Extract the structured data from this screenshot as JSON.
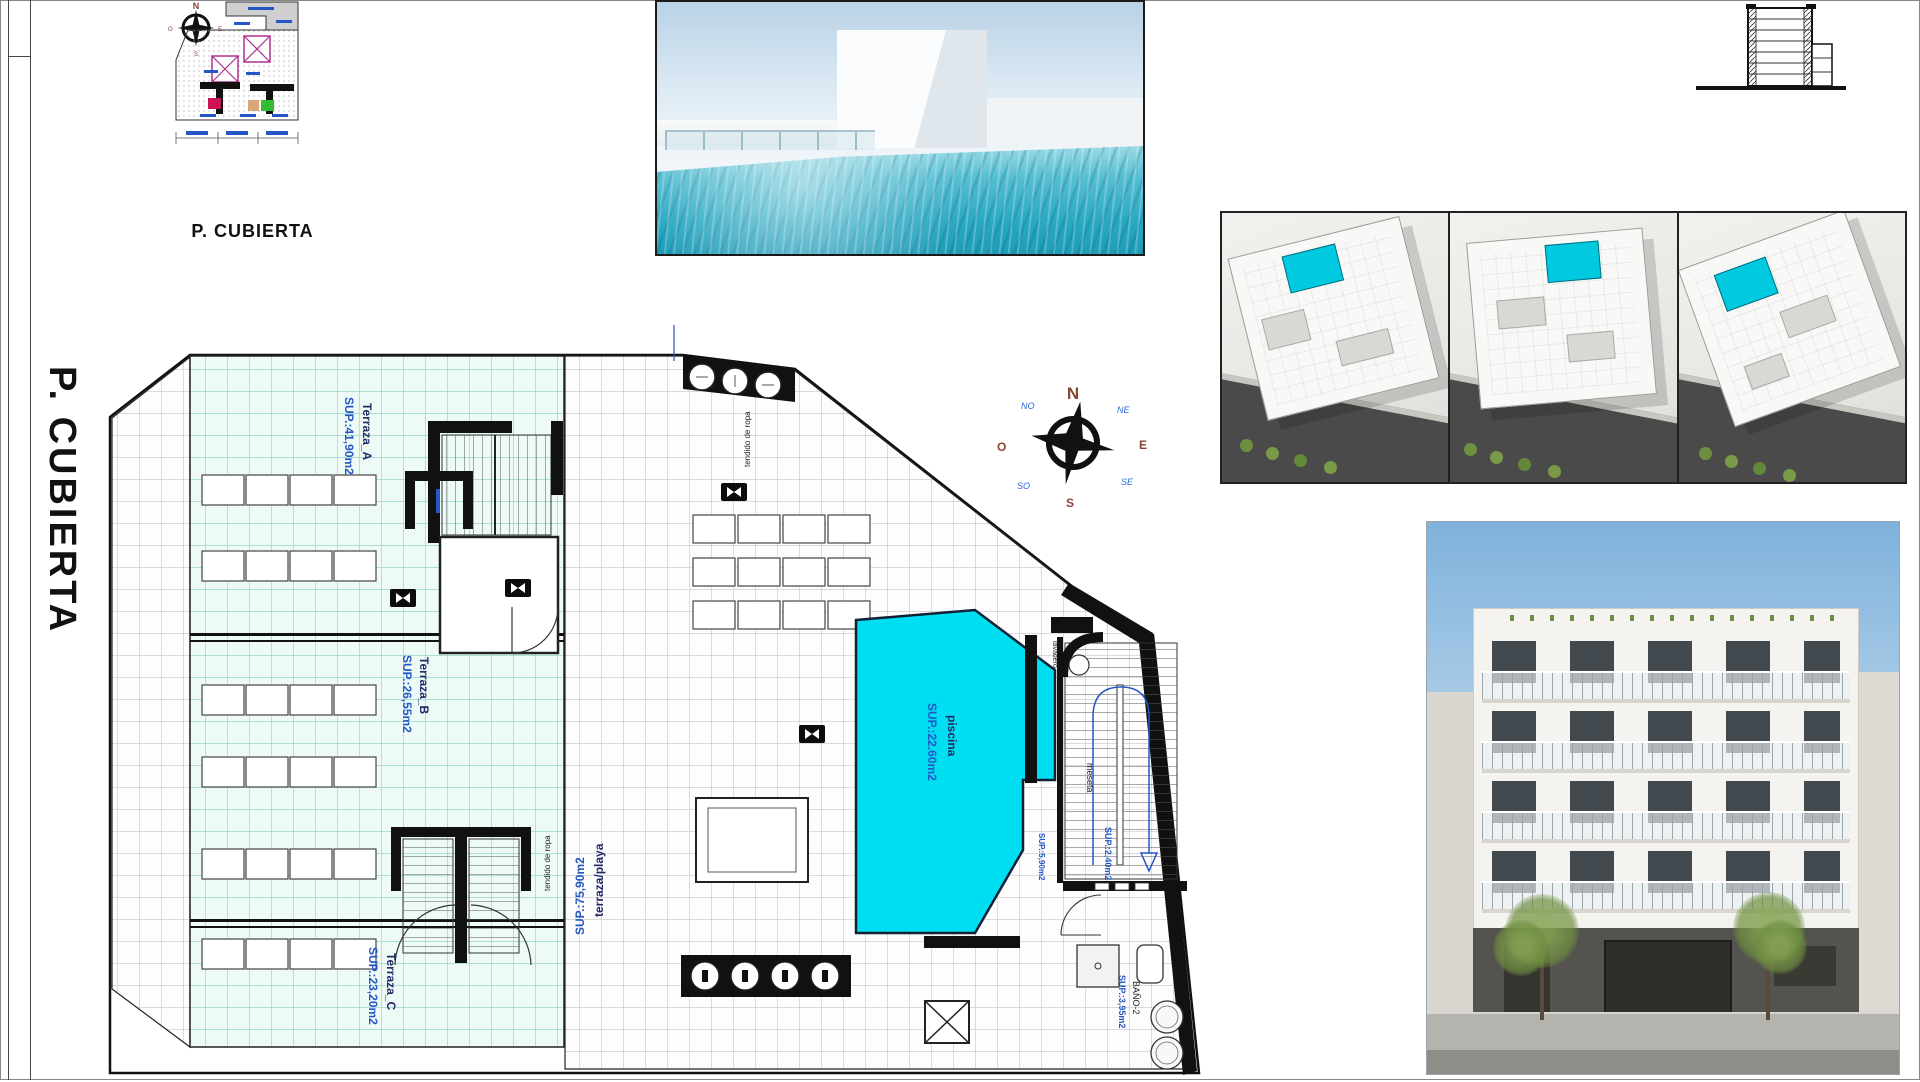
{
  "sheet": {
    "side_title": "P. CUBIERTA",
    "mini_caption": "P. CUBIERTA"
  },
  "compass": {
    "n": "N",
    "s": "S",
    "e": "E",
    "w": "O",
    "ne": "NE",
    "nw": "NO",
    "se": "SE",
    "sw": "SO"
  },
  "plan": {
    "terraza_a": {
      "name": "Terraza_A",
      "area": "SUP.:41,90m2"
    },
    "terraza_b": {
      "name": "Terraza_B",
      "area": "SUP.:26,55m2"
    },
    "terraza_c": {
      "name": "Terraza_C",
      "area": "SUP.:23,20m2"
    },
    "piscina": {
      "name": "piscina",
      "area": "SUP.:22.60m2"
    },
    "terraza_playa": {
      "name": "terraza/playa",
      "area": "SUP.:75,90m2"
    },
    "meseta": {
      "name": "meseta",
      "area": "SUP.:2,40m2"
    },
    "bano": {
      "name": "BAÑO-2",
      "area": "SUP.:3,95m2"
    },
    "lavadero": {
      "name": "lavadero"
    },
    "room_small": {
      "area": "SUP.:5,90m2"
    },
    "tendido": {
      "name": "tendido de ropa"
    }
  },
  "colors": {
    "pool_cyan": "#00dff2",
    "tile_teal_bg": "#eefaf6",
    "tile_teal_line": "#96d8cc",
    "label_blue": "#2457c5",
    "label_navy": "#232a66",
    "compass_brown": "#8a4434",
    "compass_blue": "#2b6bd8"
  }
}
